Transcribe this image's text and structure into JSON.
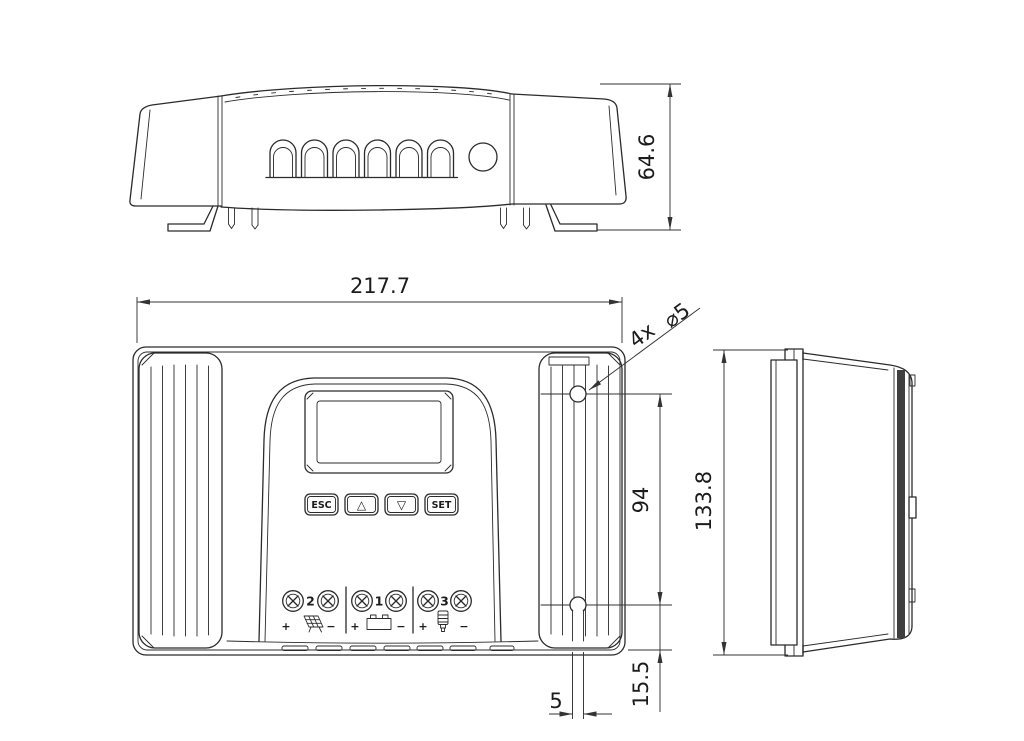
{
  "drawing": {
    "dimensions": {
      "overall_width": "217.7",
      "overall_depth": "64.6",
      "overall_height": "133.8",
      "hole_spacing": "94",
      "hole_bottom_offset": "15.5",
      "slot_width": "5"
    },
    "hole_callout": {
      "count": "4x",
      "diameter": "⌀5"
    },
    "front_panel": {
      "buttons": [
        {
          "label": "ESC"
        },
        {
          "label": "△"
        },
        {
          "label": "▽"
        },
        {
          "label": "SET"
        }
      ],
      "terminals": [
        {
          "number": "2",
          "plus": "+",
          "minus": "−",
          "icon": "solar-panel"
        },
        {
          "number": "1",
          "plus": "+",
          "minus": "−",
          "icon": "battery"
        },
        {
          "number": "3",
          "plus": "+",
          "minus": "−",
          "icon": "load-lamp"
        }
      ]
    },
    "colors": {
      "line": "#2b2b2b",
      "dimension": "#333333",
      "fin_edge": "#3f3f3f",
      "background": "#ffffff"
    }
  }
}
